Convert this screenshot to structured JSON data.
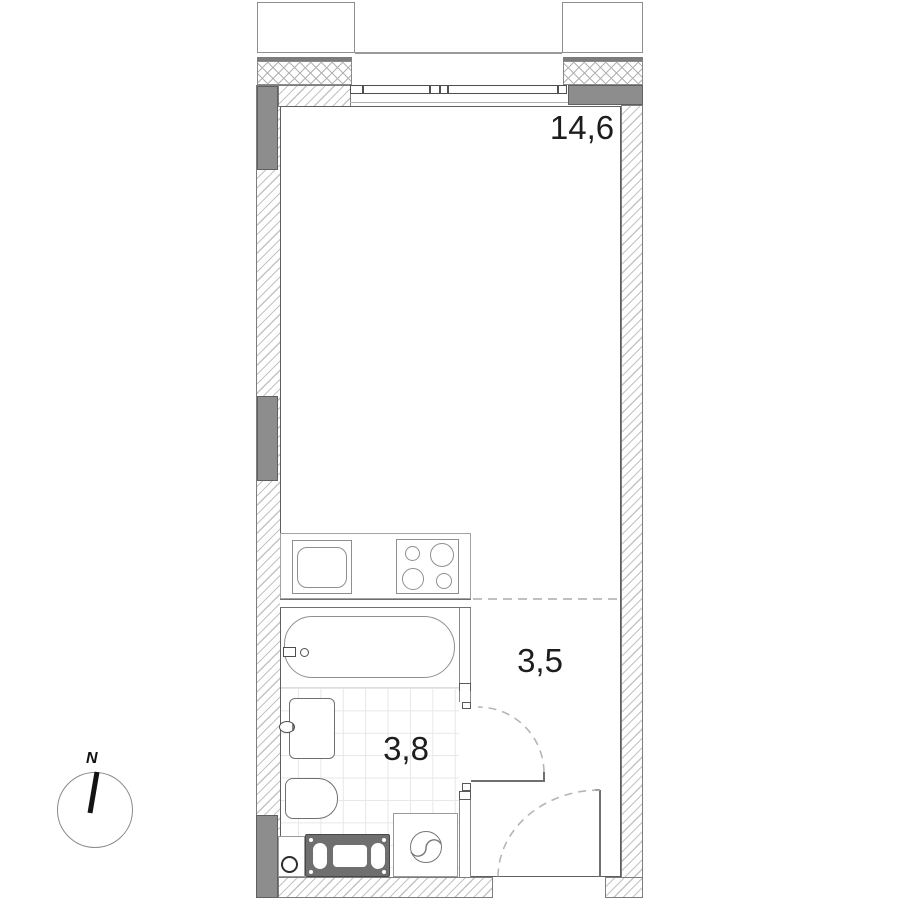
{
  "plan": {
    "rooms": [
      {
        "name": "living-room-kitchen",
        "area_label": "14,6"
      },
      {
        "name": "hallway",
        "area_label": "3,5"
      },
      {
        "name": "bathroom",
        "area_label": "3,8"
      }
    ],
    "fixtures": [
      "kitchen-sink",
      "stove",
      "bathtub",
      "washbasin",
      "toilet",
      "washing-machine",
      "radiator",
      "floor-drain",
      "bathroom-door",
      "entry-door",
      "window",
      "balcony"
    ],
    "colors": {
      "wall_fill": "#8d8d8d",
      "hatch_line": "#c3c3c3",
      "fixture_line": "#8f8f8f",
      "dark_fixture": "#6f6f6f",
      "tile_line": "#e7e7e7",
      "dash_line": "#bdbdbd",
      "text": "#1d1d1d"
    }
  },
  "compass": {
    "north_label": "N"
  }
}
